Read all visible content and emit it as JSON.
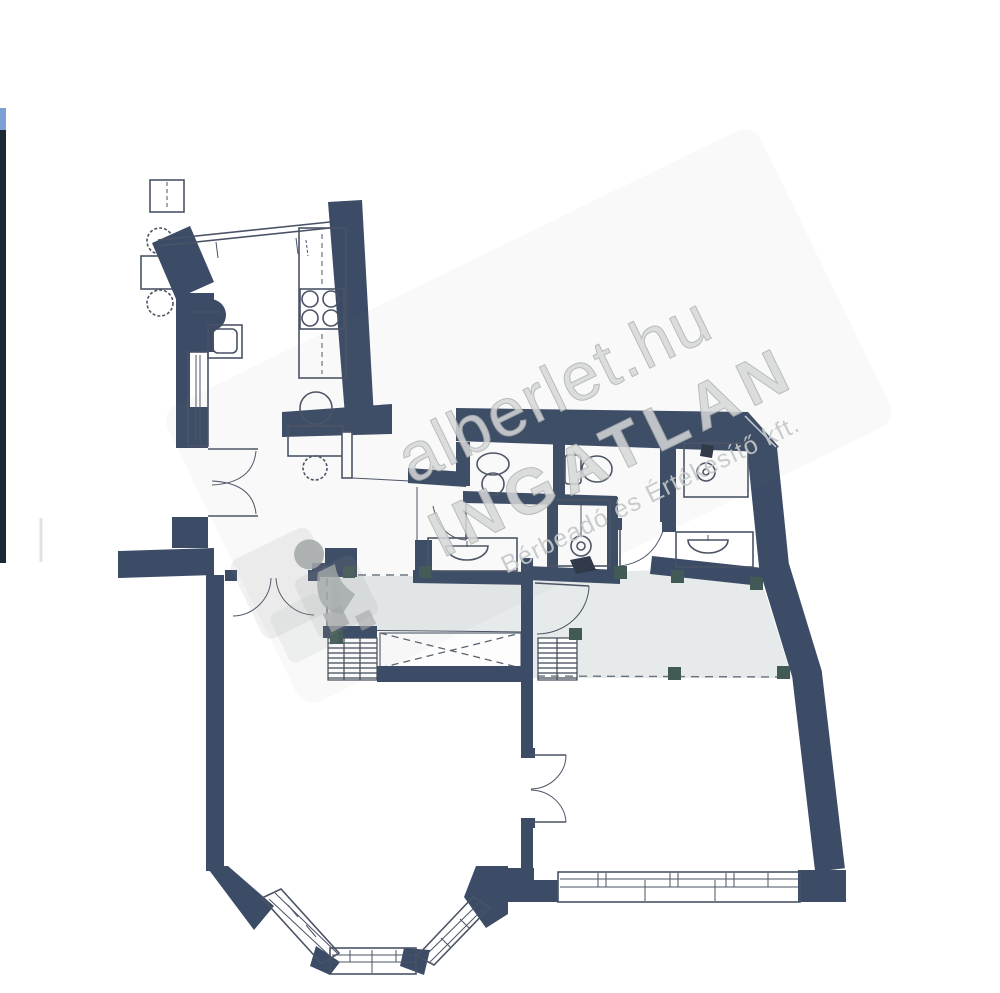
{
  "watermark": {
    "site": "alberlet.hu",
    "brand": "INGATLAN",
    "tagline": "Bérbeadó és Értékesítő kft."
  },
  "colors": {
    "wall": "#3c4b66",
    "line": "#4a5365",
    "corridor": "#e7eaea",
    "column": "#415a55",
    "watermark-fill": "#d6d8d8",
    "watermark-stroke": "#aeb2b2",
    "edge-bar": "#1d2736",
    "edge-accent": "#7aa0d4",
    "paper": "#ffffff"
  }
}
